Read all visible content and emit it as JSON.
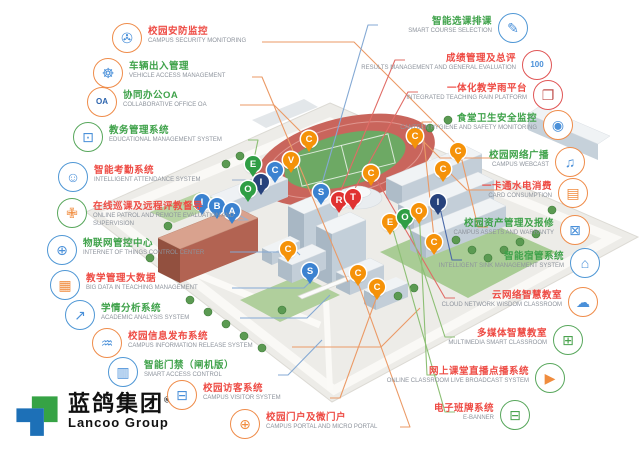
{
  "palette": {
    "cn_red": "#ee4b44",
    "cn_green": "#3fa24a",
    "en_gray": "#8d939c",
    "circle_orange": "#ef8c4a",
    "circle_blue": "#4f97d5",
    "circle_green": "#58a75c",
    "circle_red": "#e05555",
    "pin_green": "#2f9e44",
    "pin_orange": "#f59209",
    "pin_blue": "#3b82d0",
    "pin_navy": "#27427c",
    "pin_red": "#e03131",
    "logo_blue": "#1d70b7",
    "logo_green": "#36a345"
  },
  "brand": {
    "logo_cn": "蓝鸽集团",
    "reg": "®",
    "logo_en": "Lancoo Group"
  },
  "callouts": {
    "left": [
      {
        "id": "campus-security-monitoring",
        "cn": "校园安防监控",
        "en": "CAMPUS SECURITY MONITORING",
        "tone": "red",
        "circle": "#ef8c4a",
        "icon": "security-camera-icon",
        "glyph": "✇",
        "ic": "#4a90d9",
        "cx": 127,
        "cy": 38,
        "ax": 262,
        "ay": 42,
        "tx": 460,
        "ty": 148,
        "line": "#eb9a66"
      },
      {
        "id": "vehicle-access-management",
        "cn": "车辆出入管理",
        "en": "VEHICLE ACCESS MANAGEMENT",
        "tone": "green",
        "circle": "#ef8c4a",
        "icon": "car-icon",
        "glyph": "☸",
        "ic": "#4a90d9",
        "cx": 108,
        "cy": 73,
        "ax": 252,
        "ay": 77,
        "tx": 348,
        "ty": 282,
        "line": "#eb9a66"
      },
      {
        "id": "collaborative-office-oa",
        "cn": "协同办公OA",
        "en": "COLLABORATIVE OFFICE OA",
        "tone": "green",
        "circle": "#ef8c4a",
        "icon": "oa-icon",
        "glyph": "OA",
        "ic": "#2b63ad",
        "cx": 102,
        "cy": 102,
        "ax": 240,
        "ay": 105,
        "tx": 309,
        "ty": 140,
        "line": "#eb9a66"
      },
      {
        "id": "educational-management-system",
        "cn": "教务管理系统",
        "en": "EDUCATIONAL MANAGEMENT SYSTEM",
        "tone": "green",
        "circle": "#58a75c",
        "icon": "monitor-icon",
        "glyph": "⊡",
        "ic": "#4a90d9",
        "cx": 88,
        "cy": 137,
        "ax": 248,
        "ay": 140,
        "tx": 253,
        "ty": 164,
        "line": "#8cbf74"
      },
      {
        "id": "intelligent-attendance-system",
        "cn": "智能考勤系统",
        "en": "INTELLIGENT ATTENDANCE SYSTEM",
        "tone": "red",
        "circle": "#4f97d5",
        "icon": "robot-icon",
        "glyph": "☺",
        "ic": "#4a90d9",
        "cx": 73,
        "cy": 177,
        "ax": 232,
        "ay": 180,
        "tx": 261,
        "ty": 182,
        "line": "#9ab0cc"
      },
      {
        "id": "online-patrol-supervision",
        "cn": "在线巡课及远程评教督导",
        "en": "ONLINE PATROL AND REMOTE EVALUATION AND SUPERVISION",
        "tone": "red",
        "circle": "#58a75c",
        "icon": "shield-icon",
        "glyph": "✙",
        "ic": "#f08c3e",
        "cx": 72,
        "cy": 213,
        "ax": 238,
        "ay": 220,
        "tx": 231,
        "ty": 211,
        "line": "#9ab0cc"
      },
      {
        "id": "iot-control-center",
        "cn": "物联网管控中心",
        "en": "INTERNET OF THINGS CONTROL CENTER",
        "tone": "green",
        "circle": "#4f97d5",
        "icon": "globe-icon",
        "glyph": "⊕",
        "ic": "#4a90d9",
        "cx": 62,
        "cy": 250,
        "ax": 230,
        "ay": 252,
        "tx": 300,
        "ty": 255,
        "line": "#84a9d4"
      },
      {
        "id": "big-data-teaching",
        "cn": "教学管理大数据",
        "en": "BIG DATA IN TEACHING MANAGEMENT",
        "tone": "red",
        "circle": "#4f97d5",
        "icon": "chart-icon",
        "glyph": "▦",
        "ic": "#f08c3e",
        "cx": 65,
        "cy": 285,
        "ax": 232,
        "ay": 288,
        "tx": 312,
        "ty": 280,
        "line": "#84a9d4"
      },
      {
        "id": "academic-analysis-system",
        "cn": "学情分析系统",
        "en": "ACADEMIC ANALYSIS SYSTEM",
        "tone": "green",
        "circle": "#4f97d5",
        "icon": "analysis-icon",
        "glyph": "↗",
        "ic": "#4a90d9",
        "cx": 80,
        "cy": 315,
        "ax": 240,
        "ay": 318,
        "tx": 330,
        "ty": 295,
        "line": "#84a9d4"
      },
      {
        "id": "campus-information-release",
        "cn": "校园信息发布系统",
        "en": "CAMPUS INFORMATION RELEASE SYSTEM",
        "tone": "red",
        "circle": "#ef8c4a",
        "icon": "signal-icon",
        "glyph": "♒",
        "ic": "#4a90d9",
        "cx": 107,
        "cy": 343,
        "ax": 292,
        "ay": 347,
        "tx": 420,
        "ty": 308,
        "line": "#eb9a66"
      },
      {
        "id": "smart-access-control",
        "cn": "智能门禁（闸机版）",
        "en": "SMART ACCESS CONTROL",
        "tone": "green",
        "circle": "#4f97d5",
        "icon": "gate-icon",
        "glyph": "▥",
        "ic": "#4a90d9",
        "cx": 123,
        "cy": 372,
        "ax": 278,
        "ay": 375,
        "tx": 322,
        "ty": 340,
        "line": "#84a9d4"
      },
      {
        "id": "campus-visitor-system",
        "cn": "校园访客系统",
        "en": "CAMPUS VISITOR SYSTEM",
        "tone": "red",
        "circle": "#ef8c4a",
        "icon": "visitor-screen-icon",
        "glyph": "⊟",
        "ic": "#4a90d9",
        "cx": 182,
        "cy": 395,
        "ax": 330,
        "ay": 398,
        "tx": 377,
        "ty": 296,
        "line": "#eb9a66"
      }
    ],
    "bottom": [
      {
        "id": "campus-portal",
        "cn": "校园门户及微门户",
        "en": "CAMPUS PORTAL AND MICRO PORTAL",
        "tone": "red",
        "circle": "#ef8c4a",
        "icon": "portal-globe-icon",
        "glyph": "⊕",
        "ic": "#f08c3e",
        "cx": 245,
        "cy": 424,
        "ax": 400,
        "ay": 427,
        "tx": 358,
        "ty": 283,
        "line": "#eb9a66"
      }
    ],
    "right": [
      {
        "id": "smart-course-selection",
        "cn": "智能选课排课",
        "en": "SMART COURSE SELECTION",
        "tone": "green",
        "circle": "#4f97d5",
        "icon": "course-board-icon",
        "glyph": "✎",
        "ic": "#4a90d9",
        "cx": 513,
        "cy": 28,
        "ax": 378,
        "ay": 25,
        "tx": 321,
        "ty": 187,
        "line": "#84a9d4"
      },
      {
        "id": "results-management",
        "cn": "成绩管理及总评",
        "en": "RESULTS MANAGEMENT AND GENERAL EVALUATION",
        "tone": "red",
        "circle": "#e05555",
        "icon": "score-100-icon",
        "glyph": "100",
        "ic": "#4a90d9",
        "cx": 537,
        "cy": 65,
        "ax": 405,
        "ay": 60,
        "tx": 339,
        "ty": 195,
        "line": "#e06c66"
      },
      {
        "id": "integrated-teaching-platform",
        "cn": "一体化教学雨平台",
        "en": "INTEGRATED TEACHING RAIN PLATFORM",
        "tone": "red",
        "circle": "#e05555",
        "icon": "books-icon",
        "glyph": "❐",
        "ic": "#c0504d",
        "cx": 548,
        "cy": 95,
        "ax": 418,
        "ay": 92,
        "tx": 353,
        "ty": 192,
        "line": "#e06c66"
      },
      {
        "id": "canteen-hygiene-monitoring",
        "cn": "食堂卫生安全监控",
        "en": "CANTEEN HYGIENE AND SAFETY MONITORING",
        "tone": "green",
        "circle": "#ef8c4a",
        "icon": "shield-eye-icon",
        "glyph": "◉",
        "ic": "#4a90d9",
        "cx": 558,
        "cy": 125,
        "ax": 432,
        "ay": 122,
        "tx": 434,
        "ty": 238,
        "line": "#eb9a66"
      },
      {
        "id": "campus-webcast",
        "cn": "校园网络广播",
        "en": "CAMPUS WEBCAST",
        "tone": "green",
        "circle": "#ef8c4a",
        "icon": "broadcast-icon",
        "glyph": "♫",
        "ic": "#4a90d9",
        "cx": 570,
        "cy": 162,
        "ax": 498,
        "ay": 158,
        "tx": 415,
        "ty": 133,
        "line": "#eb9a66"
      },
      {
        "id": "card-consumption",
        "cn": "一卡通水电消费",
        "en": "CARD CONSUMPTION",
        "tone": "red",
        "circle": "#ef8c4a",
        "icon": "card-icon",
        "glyph": "▤",
        "ic": "#f08c3e",
        "cx": 573,
        "cy": 193,
        "ax": 502,
        "ay": 190,
        "tx": 443,
        "ty": 166,
        "line": "#eb9a66"
      },
      {
        "id": "campus-assets-warranty",
        "cn": "校园资产管理及报修",
        "en": "CAMPUS ASSETS AND WARRANTY",
        "tone": "green",
        "circle": "#ef8c4a",
        "icon": "repair-monitor-icon",
        "glyph": "⊠",
        "ic": "#4a90d9",
        "cx": 575,
        "cy": 230,
        "ax": 488,
        "ay": 227,
        "tx": 459,
        "ty": 148,
        "line": "#eb9a66"
      },
      {
        "id": "intelligent-dorm-management",
        "cn": "智能宿管系统",
        "en": "INTELLIGENT SINK MANAGEMENT SYSTEM",
        "tone": "green",
        "circle": "#4f97d5",
        "icon": "dorm-buildings-icon",
        "glyph": "⌂",
        "ic": "#4a90d9",
        "cx": 585,
        "cy": 263,
        "ax": 462,
        "ay": 260,
        "tx": 438,
        "ty": 199,
        "line": "#4a69a8"
      },
      {
        "id": "cloud-network-wisdom-classroom",
        "cn": "云网络智慧教室",
        "en": "CLOUD NETWORK WISDOM CLASSROOM",
        "tone": "red",
        "circle": "#ef8c4a",
        "icon": "cloud-icon",
        "glyph": "☁",
        "ic": "#4a90d9",
        "cx": 583,
        "cy": 302,
        "ax": 455,
        "ay": 298,
        "tx": 371,
        "ty": 170,
        "line": "#e06c66"
      },
      {
        "id": "multimedia-smart-classroom",
        "cn": "多媒体智慧教室",
        "en": "MULTIMEDIA SMART CLASSROOM",
        "tone": "red",
        "circle": "#58a75c",
        "icon": "classroom-icon",
        "glyph": "⊞",
        "ic": "#4aa34e",
        "cx": 568,
        "cy": 340,
        "ax": 455,
        "ay": 337,
        "tx": 405,
        "ty": 214,
        "line": "#8cbf74"
      },
      {
        "id": "online-classroom-broadcast",
        "cn": "网上课堂直播点播系统",
        "en": "ONLINE CLASSROOM LIVE BROADCAST SYSTEM",
        "tone": "red",
        "circle": "#58a75c",
        "icon": "video-play-icon",
        "glyph": "▶",
        "ic": "#f08c3e",
        "cx": 550,
        "cy": 378,
        "ax": 437,
        "ay": 375,
        "tx": 419,
        "ty": 208,
        "line": "#8cbf74"
      },
      {
        "id": "e-banner",
        "cn": "电子班牌系统",
        "en": "E-BANNER",
        "tone": "red",
        "circle": "#58a75c",
        "icon": "e-banner-icon",
        "glyph": "⊟",
        "ic": "#4aa34e",
        "cx": 515,
        "cy": 415,
        "ax": 455,
        "ay": 412,
        "tx": 390,
        "ty": 219,
        "line": "#8cbf74"
      }
    ]
  },
  "map": {
    "pins": [
      {
        "letter": "E",
        "color": "#2f9e44",
        "x": 253,
        "y": 164
      },
      {
        "letter": "C",
        "color": "#3b82d0",
        "x": 275,
        "y": 170
      },
      {
        "letter": "V",
        "color": "#f59209",
        "x": 291,
        "y": 160
      },
      {
        "letter": "I",
        "color": "#27427c",
        "x": 261,
        "y": 182
      },
      {
        "letter": "O",
        "color": "#2f9e44",
        "x": 248,
        "y": 189
      },
      {
        "letter": "I",
        "color": "#3b82d0",
        "x": 202,
        "y": 202
      },
      {
        "letter": "B",
        "color": "#3b82d0",
        "x": 217,
        "y": 206
      },
      {
        "letter": "A",
        "color": "#3b82d0",
        "x": 232,
        "y": 211
      },
      {
        "letter": "S",
        "color": "#3b82d0",
        "x": 321,
        "y": 192
      },
      {
        "letter": "R",
        "color": "#e03131",
        "x": 339,
        "y": 200
      },
      {
        "letter": "T",
        "color": "#e03131",
        "x": 353,
        "y": 197
      },
      {
        "letter": "C",
        "color": "#f59209",
        "x": 309,
        "y": 139
      },
      {
        "letter": "C",
        "color": "#f59209",
        "x": 371,
        "y": 173
      },
      {
        "letter": "C",
        "color": "#f59209",
        "x": 415,
        "y": 136
      },
      {
        "letter": "C",
        "color": "#f59209",
        "x": 458,
        "y": 151
      },
      {
        "letter": "C",
        "color": "#f59209",
        "x": 443,
        "y": 169
      },
      {
        "letter": "I",
        "color": "#27427c",
        "x": 438,
        "y": 202
      },
      {
        "letter": "E",
        "color": "#f59209",
        "x": 390,
        "y": 222
      },
      {
        "letter": "O",
        "color": "#2f9e44",
        "x": 405,
        "y": 217
      },
      {
        "letter": "O",
        "color": "#f59209",
        "x": 419,
        "y": 211
      },
      {
        "letter": "C",
        "color": "#f59209",
        "x": 434,
        "y": 242
      },
      {
        "letter": "C",
        "color": "#f59209",
        "x": 288,
        "y": 249
      },
      {
        "letter": "S",
        "color": "#3b82d0",
        "x": 310,
        "y": 271
      },
      {
        "letter": "C",
        "color": "#f59209",
        "x": 358,
        "y": 273
      },
      {
        "letter": "C",
        "color": "#f59209",
        "x": 377,
        "y": 287
      }
    ]
  }
}
